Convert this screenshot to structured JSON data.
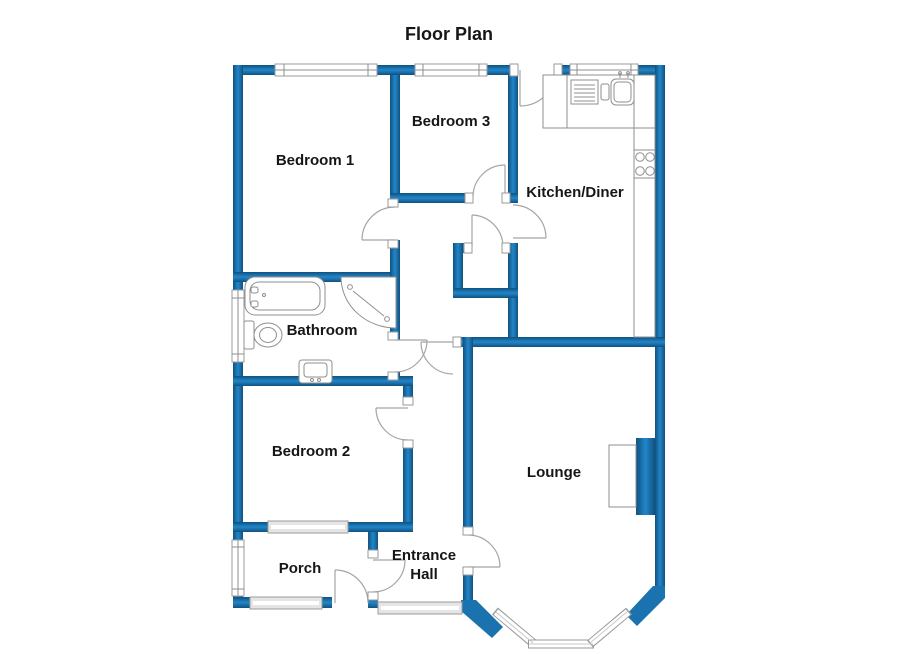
{
  "title": "Floor Plan",
  "rooms": [
    {
      "id": "bedroom-1",
      "label": "Bedroom 1"
    },
    {
      "id": "bedroom-3",
      "label": "Bedroom 3"
    },
    {
      "id": "kitchen-diner",
      "label": "Kitchen/Diner"
    },
    {
      "id": "bathroom",
      "label": "Bathroom"
    },
    {
      "id": "bedroom-2",
      "label": "Bedroom 2"
    },
    {
      "id": "lounge",
      "label": "Lounge"
    },
    {
      "id": "porch",
      "label": "Porch"
    },
    {
      "id": "entrance-hall",
      "label": "Entrance",
      "label2": "Hall"
    }
  ],
  "colors": {
    "wall_edge": "#10517f",
    "wall_mid": "#2286c9",
    "wall_solid": "#1a73ae",
    "frame_gray": "#9b9b9b",
    "text": "#161616",
    "background": "#ffffff"
  },
  "fixtures": [
    "bathtub",
    "shower-tray",
    "toilet",
    "wash-basin",
    "kitchen-sink",
    "draining-board",
    "worktop",
    "hob",
    "fireplace",
    "bay-window"
  ]
}
